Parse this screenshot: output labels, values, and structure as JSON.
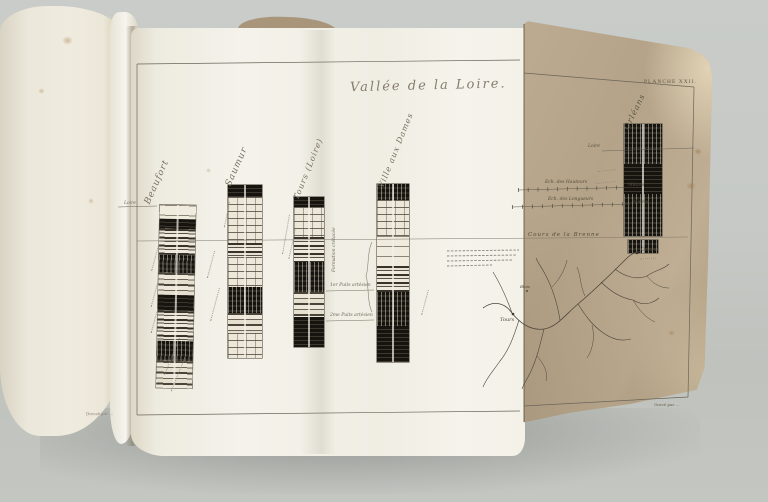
{
  "plate": {
    "title": "Vallée de la Loire.",
    "plate_number": "PLANCHE XXII.",
    "credit_left": "Dressé par …",
    "credit_right": "Gravé par …"
  },
  "columns": [
    {
      "label": "Beaufort",
      "waterline": "Loire"
    },
    {
      "label": "Saumur"
    },
    {
      "label": "Tours (Loire)"
    },
    {
      "label": "Ville aux Dames",
      "formation": "Formation crétacée"
    },
    {
      "label": "Orléans",
      "waterline": "Loire"
    }
  ],
  "annotations": {
    "well1": "1er Puits artésien",
    "well2": "2me Puits artésien"
  },
  "scales": [
    {
      "label": "Ech. des Hauteurs",
      "unit": "Mètres"
    },
    {
      "label": "Ech. des Longueurs",
      "unit": "Mètres"
    }
  ],
  "map": {
    "title": "Cours de la Brenne",
    "places": [
      "Orléans",
      "Blois",
      "Tours"
    ]
  }
}
